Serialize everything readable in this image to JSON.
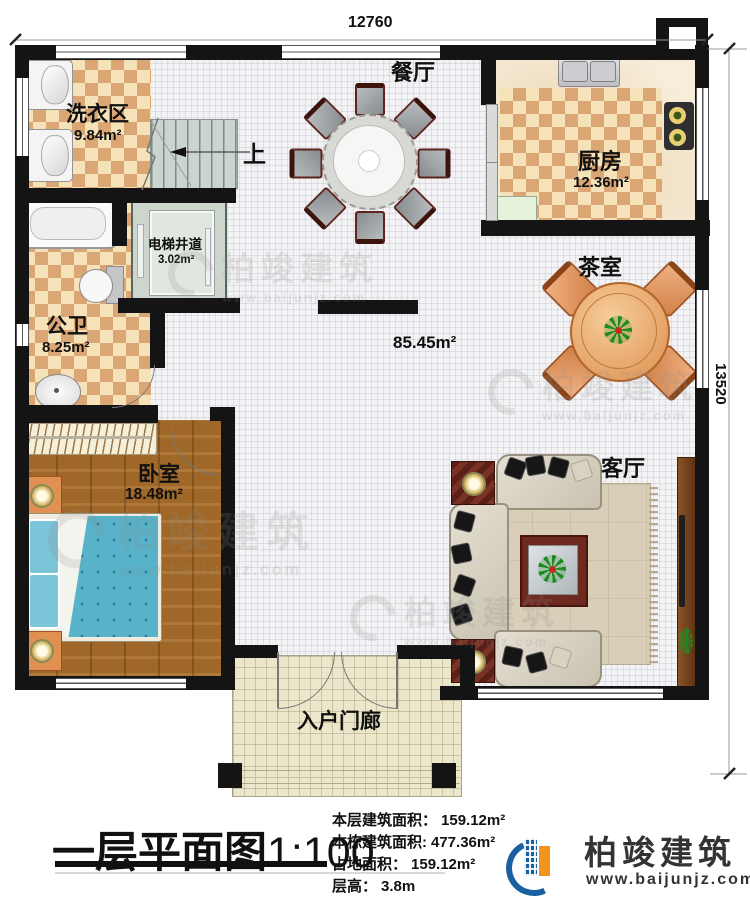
{
  "dimensions": {
    "top": "12760",
    "right": "13520"
  },
  "rooms": {
    "laundry": {
      "name": "洗衣区",
      "area": "9.84m²"
    },
    "dining": {
      "name": "餐厅"
    },
    "kitchen": {
      "name": "厨房",
      "area": "12.36m²"
    },
    "tea_room": {
      "name": "茶室"
    },
    "elevator_shaft": {
      "name": "电梯井道",
      "area": "3.02m²"
    },
    "public_bath": {
      "name": "公卫",
      "area": "8.25m²"
    },
    "bedroom": {
      "name": "卧室",
      "area": "18.48m²"
    },
    "living_room": {
      "name": "客厅"
    },
    "entry_porch": {
      "name": "入户门廊"
    },
    "hall": {
      "area": "85.45m²"
    },
    "stairs": {
      "up_label": "上"
    }
  },
  "footer": {
    "title": "一层平面图",
    "scale": "1:100",
    "stats": [
      {
        "label": "本层建筑面积：",
        "value": "159.12m²"
      },
      {
        "label": "本栋建筑面积:",
        "value": "477.36m²"
      },
      {
        "label": "占地面积：",
        "value": "159.12m²"
      },
      {
        "label": "层高：",
        "value": "3.8m"
      }
    ],
    "brand": {
      "name": "柏竣建筑",
      "url": "www.baijunjz.com"
    }
  },
  "watermark": {
    "name": "柏竣建筑",
    "url": "www.baijunjz.com"
  },
  "colors": {
    "wall": "#141414",
    "tile_light": "#f6e2b8",
    "tile_dark": "#d9a674",
    "wood_floor": "#a06828",
    "bed_blue": "#58b2ca",
    "table_orange": "#e8a468",
    "porch_floor": "#ece7cb",
    "brand_blue": "#1a5fa0",
    "brand_orange": "#f0941e"
  }
}
